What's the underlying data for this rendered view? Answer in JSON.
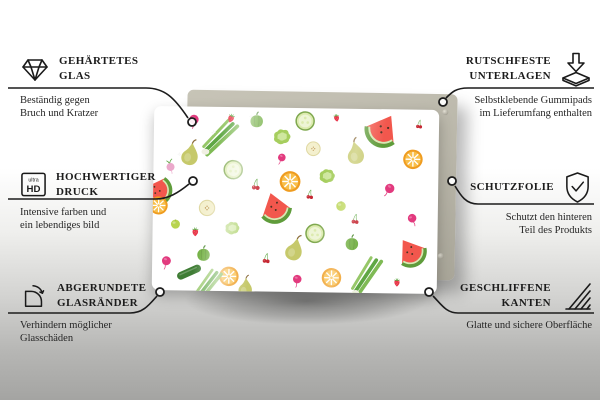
{
  "product": {
    "label": "glass board with fruit and vegetable pattern",
    "board_color": "#ffffff",
    "panel_color": "#b9b6a9",
    "background_top": "#ffffff",
    "background_bottom": "#a4a4a2",
    "palette": {
      "watermelon_flesh": "#f2574d",
      "watermelon_rind": "#5f9c3b",
      "watermelon_inner": "#d4ecb4",
      "orange_outer": "#ef9c20",
      "orange_inner": "#f8bf4b",
      "pear": "#c6c96b",
      "radish": "#e23a7e",
      "cherry": "#c62833",
      "cucumber_edge": "#7fa84f",
      "cucumber_fill": "#dcebae",
      "cucumber_dark": "#3f7d35",
      "greens": "#5fa744",
      "strawberry": "#e8364c",
      "pepper": "#6fae3e",
      "lime": "#b8d44f",
      "lettuce": "#a6ce5e",
      "turnip": "#eba9cb",
      "pale_slice": "#f4f0ce"
    },
    "pattern": [
      [
        "melon",
        2,
        46,
        40,
        -80
      ],
      [
        "radish",
        14,
        7,
        22,
        10
      ],
      [
        "scallion",
        24,
        16,
        46,
        0
      ],
      [
        "pepper",
        36,
        7,
        24,
        0
      ],
      [
        "strawberry",
        27,
        6,
        15,
        20
      ],
      [
        "cucumber",
        53,
        7,
        30,
        0
      ],
      [
        "strawberry",
        64,
        5,
        13,
        -10
      ],
      [
        "melon",
        80,
        12,
        48,
        30
      ],
      [
        "lettuce",
        45,
        16,
        26,
        0
      ],
      [
        "pear",
        13,
        26,
        34,
        8
      ],
      [
        "appleslice",
        56,
        22,
        26,
        0
      ],
      [
        "pear",
        71,
        24,
        34,
        -12
      ],
      [
        "orange",
        91,
        27,
        30,
        0
      ],
      [
        "turnip",
        6,
        33,
        20,
        -15
      ],
      [
        "cucumber",
        28,
        34,
        30,
        0
      ],
      [
        "radish",
        45,
        27,
        18,
        25
      ],
      [
        "cherry",
        36,
        42,
        18,
        0
      ],
      [
        "lettuce",
        61,
        37,
        24,
        0
      ],
      [
        "orange",
        48,
        40,
        32,
        0
      ],
      [
        "radish",
        83,
        43,
        22,
        35
      ],
      [
        "orange",
        2,
        54,
        28,
        0
      ],
      [
        "appleslice",
        19,
        55,
        29,
        0
      ],
      [
        "melon",
        43,
        55,
        44,
        -18
      ],
      [
        "lime",
        66,
        53,
        20,
        0
      ],
      [
        "cherry",
        71,
        60,
        16,
        0
      ],
      [
        "radish",
        91,
        59,
        20,
        -20
      ],
      [
        "lime",
        8,
        64,
        19,
        0
      ],
      [
        "strawberry",
        15,
        68,
        15,
        0
      ],
      [
        "lettuce",
        28,
        66,
        22,
        0
      ],
      [
        "cucumber",
        57,
        68,
        30,
        0
      ],
      [
        "pear",
        50,
        77,
        34,
        12
      ],
      [
        "pepper",
        70,
        73,
        24,
        0
      ],
      [
        "melon",
        91,
        78,
        42,
        -35
      ],
      [
        "pepper",
        18,
        80,
        24,
        0
      ],
      [
        "radish",
        5,
        84,
        21,
        15
      ],
      [
        "cherry",
        40,
        82,
        16,
        0
      ],
      [
        "cukewhole",
        13,
        90,
        34,
        -25
      ],
      [
        "orange",
        27,
        92,
        30,
        0
      ],
      [
        "scallion",
        20,
        97,
        42,
        -8
      ],
      [
        "pear",
        33,
        98,
        28,
        0
      ],
      [
        "orange",
        63,
        92,
        30,
        0
      ],
      [
        "scallion",
        76,
        90,
        46,
        -12
      ],
      [
        "radish",
        51,
        93,
        20,
        10
      ],
      [
        "strawberry",
        86,
        94,
        14,
        0
      ],
      [
        "cherry",
        93,
        8,
        14,
        0
      ],
      [
        "cherry",
        55,
        47,
        15,
        0
      ],
      [
        "sparkle",
        21,
        14,
        13,
        0
      ],
      [
        "sparkle",
        34,
        5,
        10,
        0
      ],
      [
        "sparkle",
        9,
        26,
        9,
        0
      ]
    ]
  },
  "callouts": {
    "tempered_glass": {
      "icon": "diamond-icon",
      "title_lines": [
        "GEHÄRTETES",
        "GLAS"
      ],
      "desc_lines": [
        "Beständig gegen",
        "Bruch und Kratzer"
      ]
    },
    "print": {
      "icon": "ultra-hd-icon",
      "icon_text_top": "ultra",
      "icon_text_bottom": "HD",
      "title_lines": [
        "HOCHWERTIGER",
        "DRUCK"
      ],
      "desc_lines": [
        "Intensive farben und",
        "ein lebendiges bild"
      ]
    },
    "rounded_edges": {
      "icon": "rounded-corner-icon",
      "title_lines": [
        "ABGERUNDETE",
        "GLASRÄNDER"
      ],
      "desc_lines": [
        "Verhindern möglicher",
        "Glasschäden"
      ]
    },
    "anti_slip": {
      "icon": "anti-slip-pad-icon",
      "title_lines": [
        "RUTSCHFESTE",
        "UNTERLAGEN"
      ],
      "desc_lines": [
        "Selbstklebende Gummipads",
        "im Lieferumfang enthalten"
      ]
    },
    "protective_film": {
      "icon": "shield-check-icon",
      "title_lines": [
        "SCHUTZFOLIE"
      ],
      "desc_lines": [
        "Schutzt den hinteren",
        "Teil des Produkts"
      ]
    },
    "polished_edges": {
      "icon": "hatched-edge-icon",
      "title_lines": [
        "GESCHLIFFENE",
        "KANTEN"
      ],
      "desc_lines": [
        "Glatte und sichere Oberfläche"
      ]
    }
  }
}
